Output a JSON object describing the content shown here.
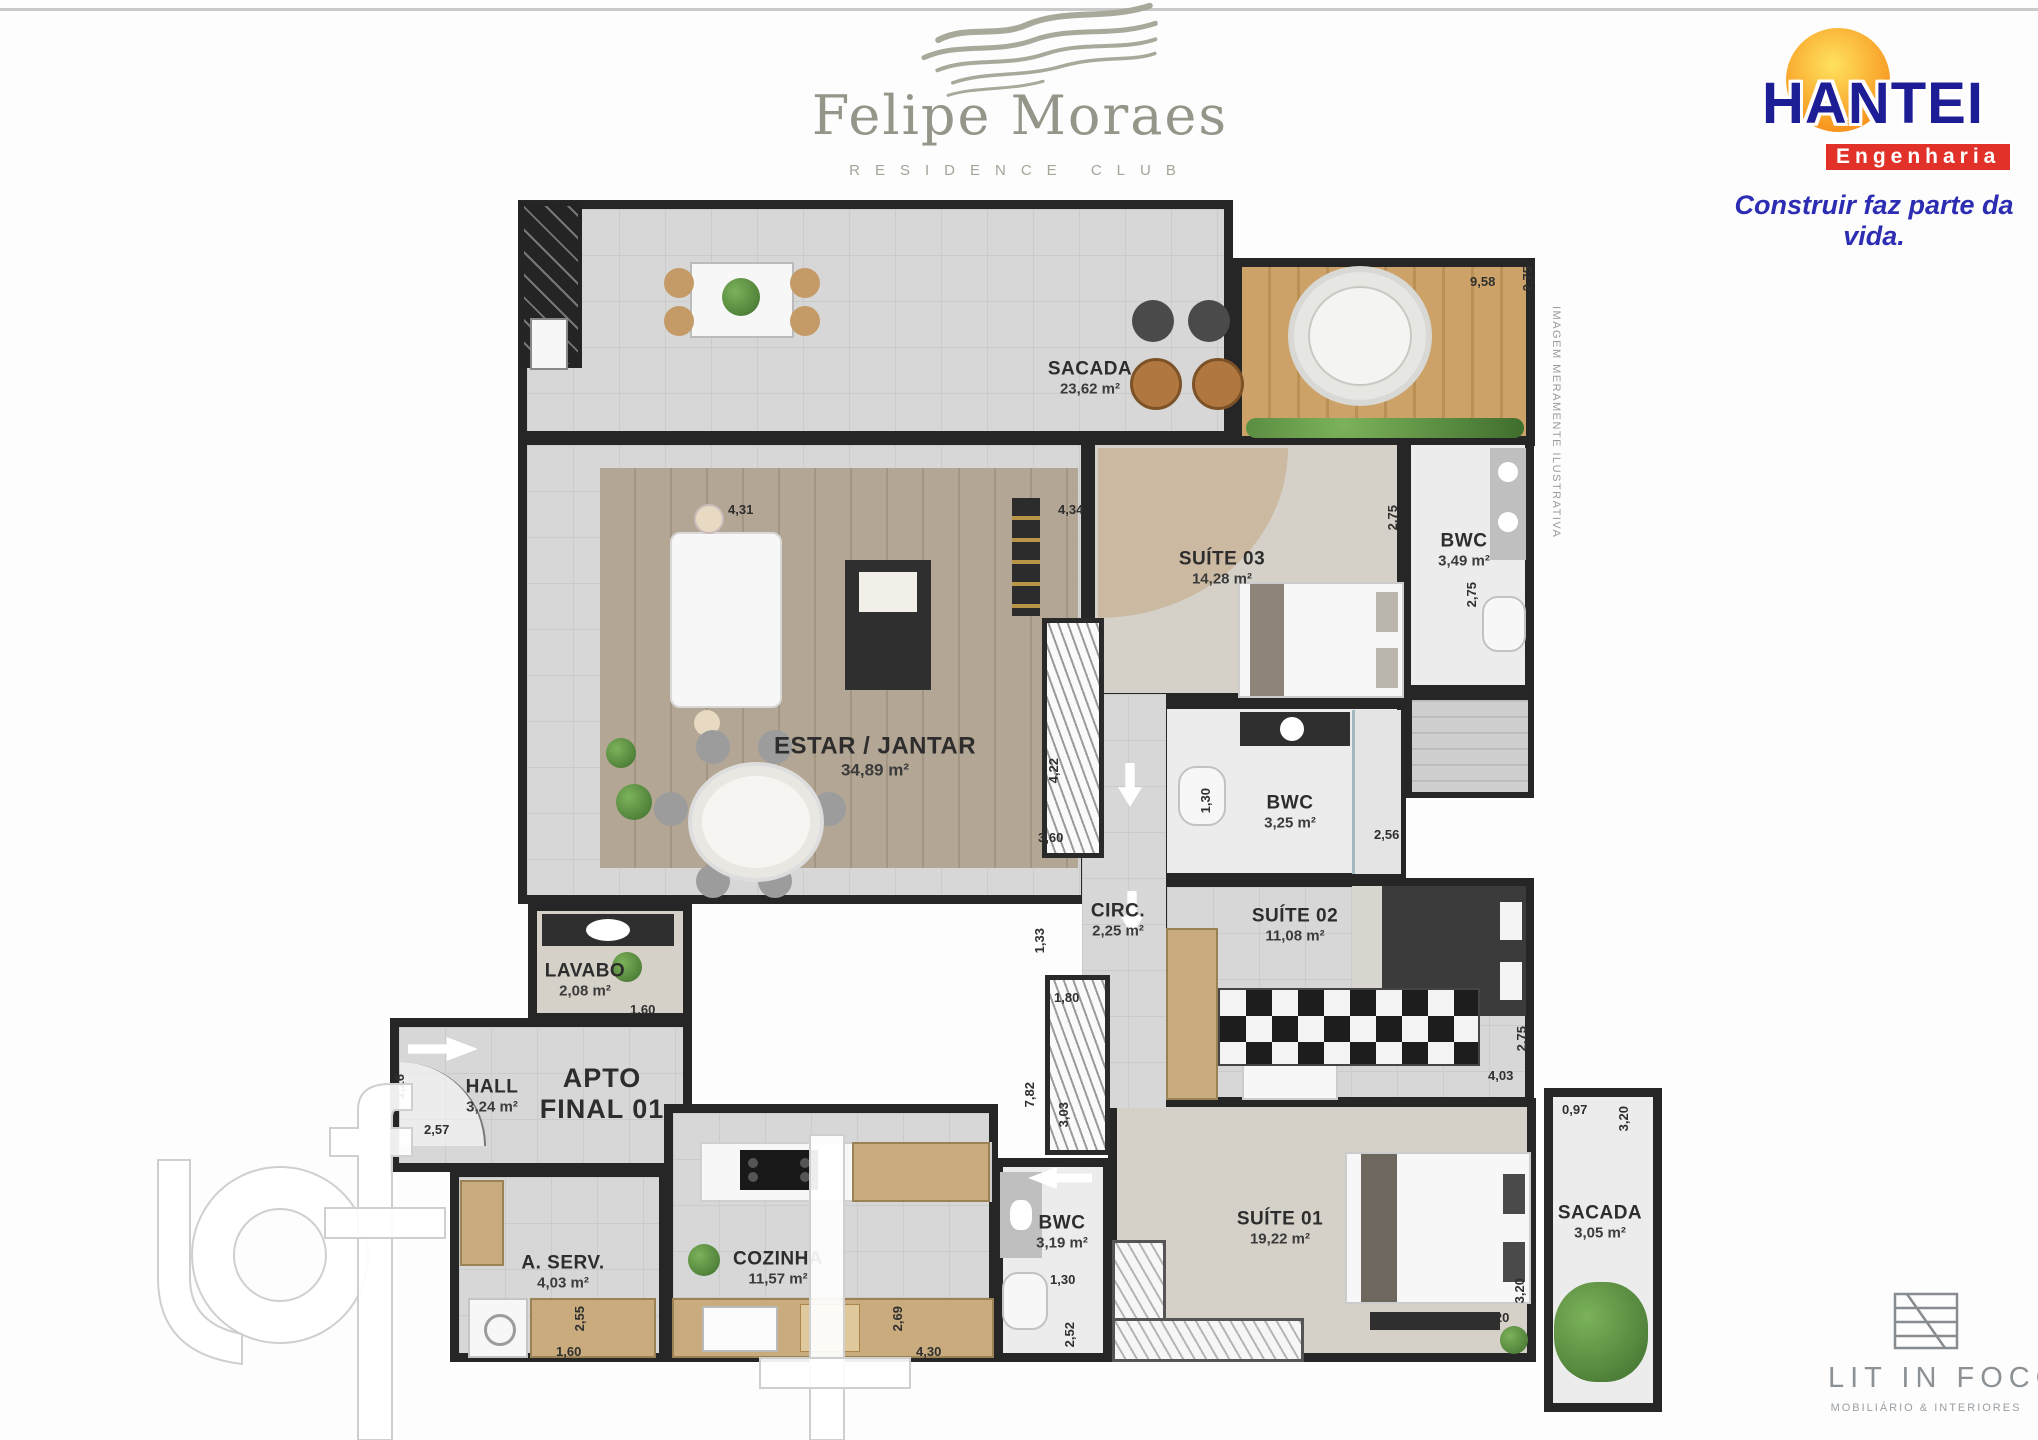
{
  "branding": {
    "felipe": {
      "name": "Felipe Moraes",
      "subtitle": "RESIDENCE CLUB"
    },
    "hantei": {
      "name": "HANTEI",
      "division": "Engenharia",
      "tagline": "Construir faz parte da vida."
    },
    "litinfoco": {
      "name": "LIT IN FOCO",
      "subtitle": "MOBILIÁRIO & INTERIORES"
    },
    "disclaimer": "IMAGEM MERAMENTE ILUSTRATIVA"
  },
  "plan": {
    "apto": {
      "line1": "APTO",
      "line2": "FINAL 01"
    },
    "rooms": [
      {
        "name": "SACADA",
        "area": "23,62 m²"
      },
      {
        "name": "SUÍTE 03",
        "area": "14,28 m²"
      },
      {
        "name": "BWC",
        "area": "3,49 m²"
      },
      {
        "name": "ESTAR / JANTAR",
        "area": "34,89 m²"
      },
      {
        "name": "BWC",
        "area": "3,25 m²"
      },
      {
        "name": "CIRC.",
        "area": "2,25 m²"
      },
      {
        "name": "SUÍTE 02",
        "area": "11,08 m²"
      },
      {
        "name": "LAVABO",
        "area": "2,08 m²"
      },
      {
        "name": "HALL",
        "area": "3,24 m²"
      },
      {
        "name": "A. SERV.",
        "area": "4,03 m²"
      },
      {
        "name": "COZINHA",
        "area": "11,57 m²"
      },
      {
        "name": "BWC",
        "area": "3,19 m²"
      },
      {
        "name": "SUÍTE 01",
        "area": "19,22 m²"
      },
      {
        "name": "SACADA",
        "area": "3,05 m²"
      }
    ],
    "dimensions": [
      "4,31",
      "4,34",
      "9,58",
      "2,75",
      "2,75",
      "2,75",
      "4,22",
      "3,60",
      "1,30",
      "2,56",
      "1,33",
      "1,80",
      "7,82",
      "3,03",
      "2,75",
      "4,03",
      "1,60",
      "2,57",
      "1,26",
      "2,55",
      "1,60",
      "2,69",
      "4,30",
      "1,30",
      "2,52",
      "5,20",
      "3,20",
      "0,97",
      "3,20"
    ]
  }
}
